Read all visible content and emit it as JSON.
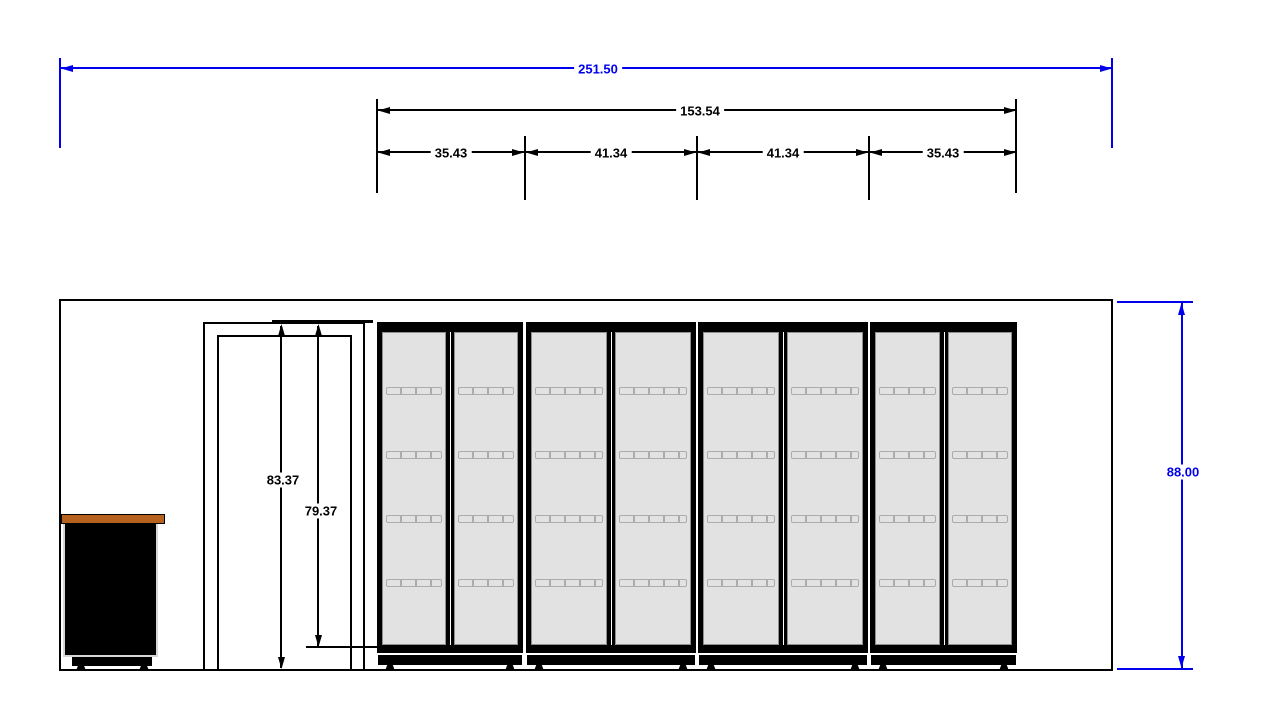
{
  "dimensions": {
    "overall_width": "251.50",
    "lineup_width": "153.54",
    "bay_widths": [
      "35.43",
      "41.34",
      "41.34",
      "35.43"
    ],
    "door_frame_height": "83.37",
    "door_opening_height": "79.37",
    "wall_height": "88.00"
  },
  "colors": {
    "dimension_blue": "#0000ee",
    "line_black": "#000000",
    "glass_gray": "#e2e2e2",
    "counter_top_brown": "#b4621d"
  },
  "scene": {
    "cooler_sections": 4,
    "doors_per_section": 2,
    "shelf_rows_per_door": 4
  }
}
